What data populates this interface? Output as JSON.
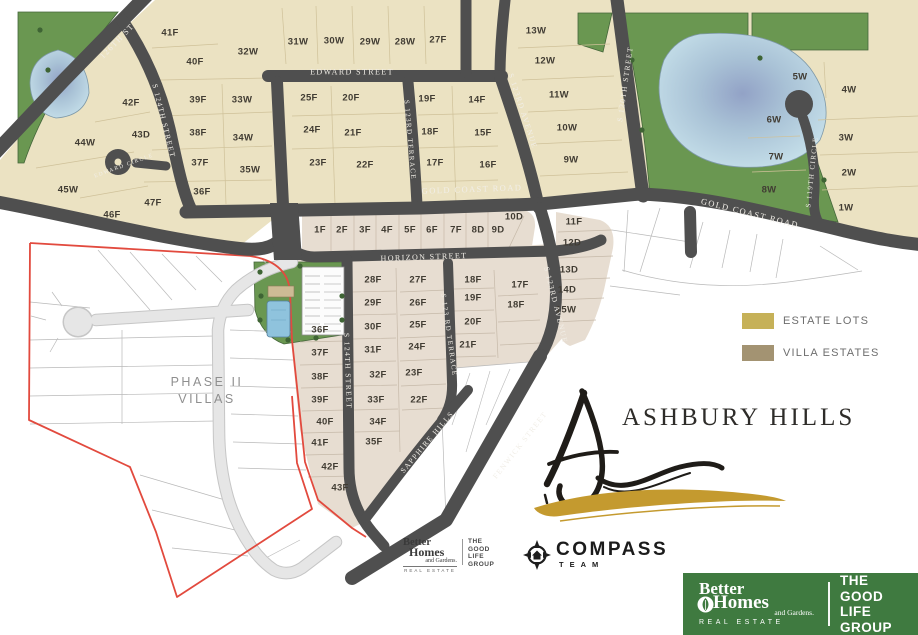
{
  "title": {
    "name": "ASHBURY HILLS"
  },
  "legend": {
    "items": [
      {
        "label": "ESTATE LOTS",
        "color": "#c6b158"
      },
      {
        "label": "VILLA ESTATES",
        "color": "#a39372"
      }
    ]
  },
  "phase_label": {
    "line1": "PHASE II",
    "line2": "VILLAS"
  },
  "colors": {
    "estate_lot_fill": "#ebe2c2",
    "villa_lot_fill": "#e7ddd1",
    "street_dark": "#4f4f4f",
    "park_green": "#6a9751",
    "boundary_red": "#e24a3e",
    "brand_green": "#3f7a40"
  },
  "map": {
    "street_labels": [
      {
        "t": "126TH ST",
        "x": 117,
        "y": 41,
        "r": -46,
        "fs": 8
      },
      {
        "t": "S 124TH STREET",
        "x": 164,
        "y": 121,
        "r": 76,
        "fs": 7.5
      },
      {
        "t": "EDWARD CIRCLE",
        "x": 124,
        "y": 166,
        "r": -20,
        "fs": 5.5
      },
      {
        "t": "EDWARD STREET",
        "x": 352,
        "y": 72,
        "r": 0,
        "fs": 8
      },
      {
        "t": "S 123RD TERRACE",
        "x": 410,
        "y": 140,
        "r": 85,
        "fs": 7
      },
      {
        "t": "S 123RD AVENUE",
        "x": 523,
        "y": 111,
        "r": 72,
        "fs": 7.5
      },
      {
        "t": "S 120TH STREET",
        "x": 625,
        "y": 84,
        "r": -82,
        "fs": 7.5
      },
      {
        "t": "GOLD COAST ROAD",
        "x": 472,
        "y": 189,
        "r": -2,
        "fs": 8.5
      },
      {
        "t": "GOLD COAST ROAD",
        "x": 750,
        "y": 213,
        "r": 14,
        "fs": 8.5
      },
      {
        "t": "HORIZON STREET",
        "x": 424,
        "y": 257,
        "r": -2,
        "fs": 8
      },
      {
        "t": "S 124TH STREET",
        "x": 348,
        "y": 371,
        "r": 88,
        "fs": 7.5
      },
      {
        "t": "S 123 RD TERRACE",
        "x": 449,
        "y": 335,
        "r": 82,
        "fs": 7
      },
      {
        "t": "S 123RD AVENUE",
        "x": 556,
        "y": 305,
        "r": 76,
        "fs": 7.5
      },
      {
        "t": "SAPPHIRE HILLS",
        "x": 427,
        "y": 442,
        "r": -50,
        "fs": 7.5
      },
      {
        "t": "FENWICK STREET",
        "x": 520,
        "y": 445,
        "r": -52,
        "fs": 7.5
      },
      {
        "t": "S 119TH CIRCLE",
        "x": 812,
        "y": 172,
        "r": -84,
        "fs": 7
      }
    ],
    "lot_labels": [
      {
        "t": "41F",
        "x": 170,
        "y": 33
      },
      {
        "t": "40F",
        "x": 195,
        "y": 62
      },
      {
        "t": "32W",
        "x": 248,
        "y": 52
      },
      {
        "t": "31W",
        "x": 298,
        "y": 42
      },
      {
        "t": "30W",
        "x": 334,
        "y": 41
      },
      {
        "t": "29W",
        "x": 370,
        "y": 42
      },
      {
        "t": "28W",
        "x": 405,
        "y": 42
      },
      {
        "t": "27F",
        "x": 438,
        "y": 40
      },
      {
        "t": "13W",
        "x": 536,
        "y": 31
      },
      {
        "t": "12W",
        "x": 545,
        "y": 61
      },
      {
        "t": "11W",
        "x": 559,
        "y": 95
      },
      {
        "t": "10W",
        "x": 567,
        "y": 128
      },
      {
        "t": "9W",
        "x": 571,
        "y": 160
      },
      {
        "t": "42F",
        "x": 131,
        "y": 103
      },
      {
        "t": "39F",
        "x": 198,
        "y": 100
      },
      {
        "t": "33W",
        "x": 242,
        "y": 100
      },
      {
        "t": "25F",
        "x": 309,
        "y": 98
      },
      {
        "t": "20F",
        "x": 351,
        "y": 98
      },
      {
        "t": "19F",
        "x": 427,
        "y": 99
      },
      {
        "t": "14F",
        "x": 477,
        "y": 100
      },
      {
        "t": "43D",
        "x": 141,
        "y": 135
      },
      {
        "t": "38F",
        "x": 198,
        "y": 133
      },
      {
        "t": "34W",
        "x": 243,
        "y": 138
      },
      {
        "t": "24F",
        "x": 312,
        "y": 130
      },
      {
        "t": "21F",
        "x": 353,
        "y": 133
      },
      {
        "t": "18F",
        "x": 430,
        "y": 132
      },
      {
        "t": "15F",
        "x": 483,
        "y": 133
      },
      {
        "t": "44W",
        "x": 85,
        "y": 143
      },
      {
        "t": "37F",
        "x": 200,
        "y": 163
      },
      {
        "t": "35W",
        "x": 250,
        "y": 170
      },
      {
        "t": "23F",
        "x": 318,
        "y": 163
      },
      {
        "t": "22F",
        "x": 365,
        "y": 165
      },
      {
        "t": "17F",
        "x": 435,
        "y": 163
      },
      {
        "t": "16F",
        "x": 488,
        "y": 165
      },
      {
        "t": "45W",
        "x": 68,
        "y": 190
      },
      {
        "t": "36F",
        "x": 202,
        "y": 192
      },
      {
        "t": "47F",
        "x": 153,
        "y": 203
      },
      {
        "t": "46F",
        "x": 112,
        "y": 215
      },
      {
        "t": "5W",
        "x": 800,
        "y": 77
      },
      {
        "t": "4W",
        "x": 849,
        "y": 90
      },
      {
        "t": "6W",
        "x": 774,
        "y": 120
      },
      {
        "t": "3W",
        "x": 846,
        "y": 138
      },
      {
        "t": "7W",
        "x": 776,
        "y": 157
      },
      {
        "t": "2W",
        "x": 849,
        "y": 173
      },
      {
        "t": "8W",
        "x": 769,
        "y": 190
      },
      {
        "t": "1W",
        "x": 846,
        "y": 208
      },
      {
        "t": "1F",
        "x": 320,
        "y": 230
      },
      {
        "t": "2F",
        "x": 342,
        "y": 230
      },
      {
        "t": "3F",
        "x": 365,
        "y": 230
      },
      {
        "t": "4F",
        "x": 387,
        "y": 230
      },
      {
        "t": "5F",
        "x": 410,
        "y": 230
      },
      {
        "t": "6F",
        "x": 432,
        "y": 230
      },
      {
        "t": "7F",
        "x": 456,
        "y": 230
      },
      {
        "t": "8D",
        "x": 478,
        "y": 230
      },
      {
        "t": "9D",
        "x": 498,
        "y": 230
      },
      {
        "t": "10D",
        "x": 514,
        "y": 217
      },
      {
        "t": "11F",
        "x": 574,
        "y": 222
      },
      {
        "t": "12D",
        "x": 572,
        "y": 243
      },
      {
        "t": "13D",
        "x": 569,
        "y": 270
      },
      {
        "t": "14D",
        "x": 567,
        "y": 290
      },
      {
        "t": "15W",
        "x": 566,
        "y": 310
      },
      {
        "t": "28F",
        "x": 373,
        "y": 280
      },
      {
        "t": "27F",
        "x": 418,
        "y": 280
      },
      {
        "t": "18F",
        "x": 473,
        "y": 280
      },
      {
        "t": "17F",
        "x": 520,
        "y": 285
      },
      {
        "t": "29F",
        "x": 373,
        "y": 303
      },
      {
        "t": "26F",
        "x": 418,
        "y": 303
      },
      {
        "t": "19F",
        "x": 473,
        "y": 298
      },
      {
        "t": "18F",
        "x": 516,
        "y": 305
      },
      {
        "t": "30F",
        "x": 373,
        "y": 327
      },
      {
        "t": "25F",
        "x": 418,
        "y": 325
      },
      {
        "t": "20F",
        "x": 473,
        "y": 322
      },
      {
        "t": "31F",
        "x": 373,
        "y": 350
      },
      {
        "t": "24F",
        "x": 417,
        "y": 347
      },
      {
        "t": "21F",
        "x": 468,
        "y": 345
      },
      {
        "t": "32F",
        "x": 378,
        "y": 375
      },
      {
        "t": "23F",
        "x": 414,
        "y": 373
      },
      {
        "t": "33F",
        "x": 376,
        "y": 400
      },
      {
        "t": "22F",
        "x": 419,
        "y": 400
      },
      {
        "t": "34F",
        "x": 378,
        "y": 422
      },
      {
        "t": "35F",
        "x": 374,
        "y": 442
      },
      {
        "t": "36F",
        "x": 320,
        "y": 330
      },
      {
        "t": "37F",
        "x": 320,
        "y": 353
      },
      {
        "t": "38F",
        "x": 320,
        "y": 377
      },
      {
        "t": "39F",
        "x": 320,
        "y": 400
      },
      {
        "t": "40F",
        "x": 325,
        "y": 422
      },
      {
        "t": "41F",
        "x": 320,
        "y": 443
      },
      {
        "t": "42F",
        "x": 330,
        "y": 467
      },
      {
        "t": "43F",
        "x": 340,
        "y": 488
      }
    ]
  },
  "footer": {
    "bhg": {
      "line1": "Better",
      "line2": "Homes",
      "line3": "and Gardens.",
      "line4": "REAL ESTATE"
    },
    "tglg": {
      "l1": "THE",
      "l2": "GOOD LIFE",
      "l3": "GROUP"
    },
    "compass": {
      "name": "COMPASS",
      "team": "TEAM"
    }
  },
  "brand_box": {
    "line1": "Better",
    "line2": "Homes",
    "line3": "and Gardens.",
    "line4": "REAL ESTATE",
    "right1": "THE",
    "right2": "GOOD LIFE",
    "right3": "GROUP"
  }
}
